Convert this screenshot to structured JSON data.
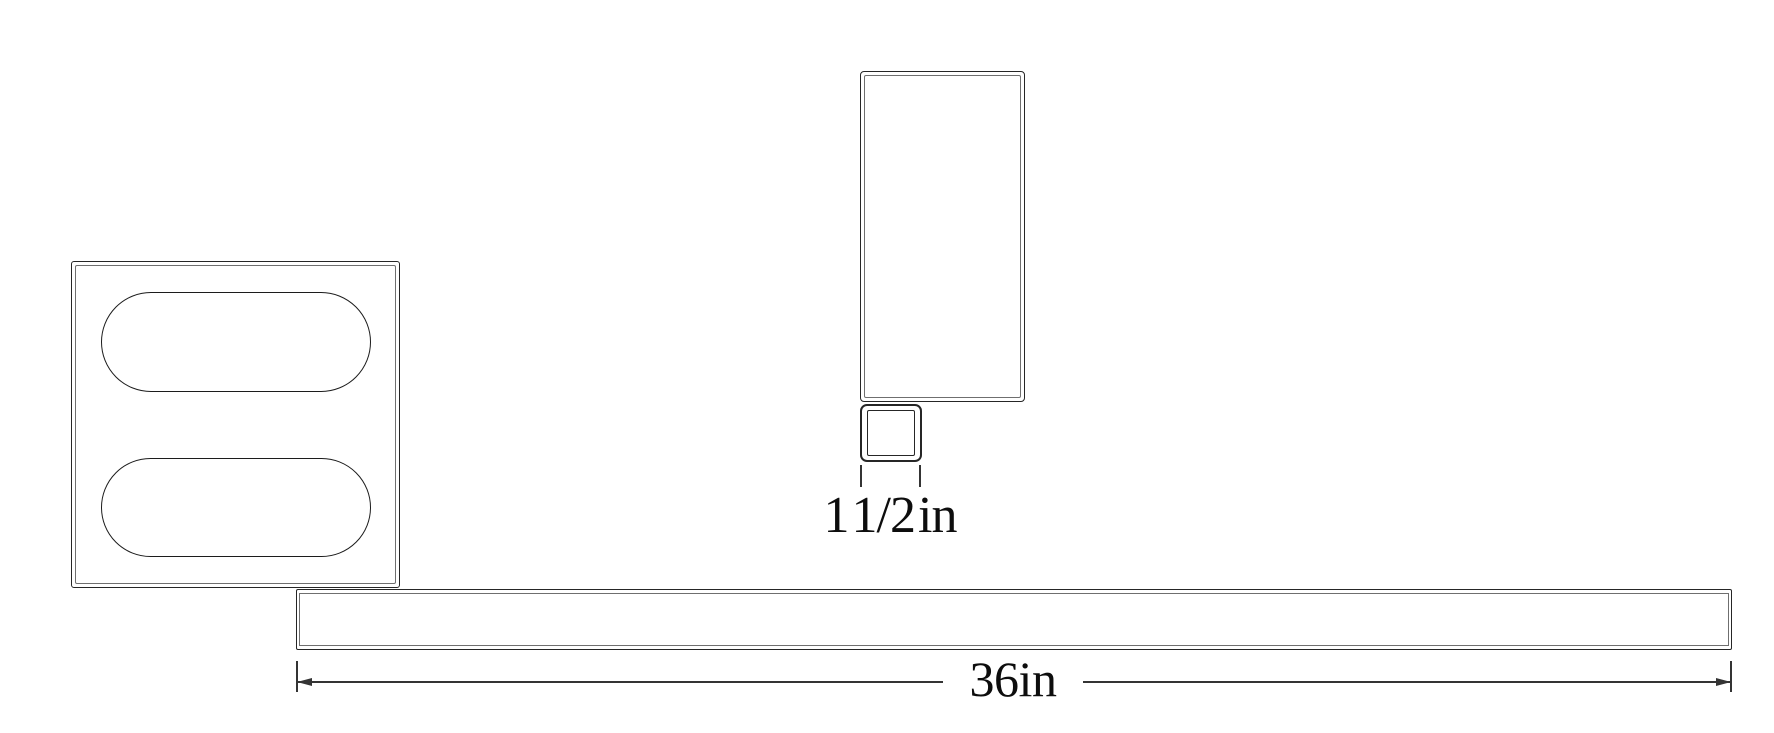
{
  "drawing": {
    "kind": "cad-sketch",
    "parts": [
      "slotted-plate",
      "vertical-rectangular-tube",
      "square-tube-cross-section",
      "long-flat-bar"
    ]
  },
  "labels": {
    "square_tube_width": "1 1/2 in",
    "bar_length": "36in"
  },
  "colors": {
    "background": "#ffffff",
    "line": "#262626",
    "inner_line": "#6f6f6f",
    "slot_line": "#1c1c1c",
    "dim_line": "#343434",
    "text": "#0d0d0d"
  }
}
